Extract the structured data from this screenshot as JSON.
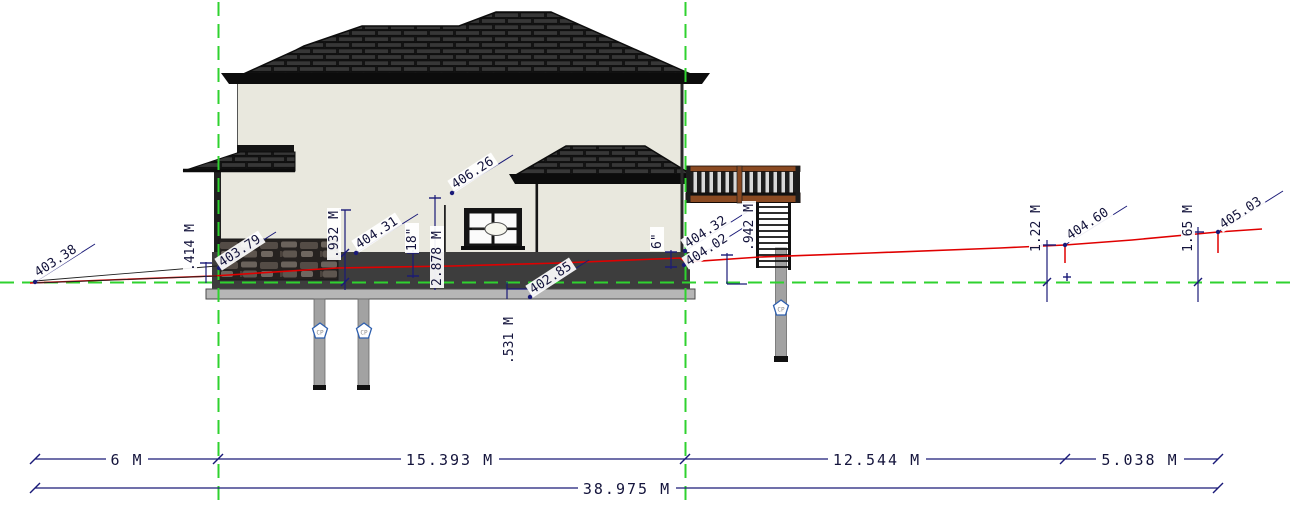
{
  "drawing": {
    "type": "building-elevation-section",
    "spot_elevations": {
      "grade_far_left": "403.38",
      "house_left": "403.79",
      "foundation_mid": "404.31",
      "wall_upper": "406.26",
      "footing_bottom": "402.85",
      "deck_corner_upper": "404.32",
      "deck_corner_lower": "404.02",
      "grade_right_1": "404.60",
      "grade_right_2": "405.03"
    },
    "vertical_dimensions": {
      "left_grade_delta": ".414 M",
      "stone_height": ".932 M",
      "frost_depth": "18\"",
      "wall_height": "2.878 M",
      "footing_depth": ".531 M",
      "reveal": "6\"",
      "deck_height": ".942 M",
      "grade_rise_1": "1.22 M",
      "grade_rise_2": "1.65 M"
    },
    "horizontal_dimensions": {
      "segment_1": "6 M",
      "segment_2": "15.393 M",
      "segment_3": "12.544 M",
      "segment_4": "5.038 M",
      "overall": "38.975 M"
    },
    "pier_badge_label": "CP",
    "colors": {
      "terrain_line": "#e00000",
      "datum_line": "#2fd22f",
      "dimension": "#1a1a78",
      "wall": "#e9e8de",
      "roof": "#1a1a1a",
      "deck_wood": "#8a4a22",
      "foundation": "#3d3d3d"
    }
  }
}
